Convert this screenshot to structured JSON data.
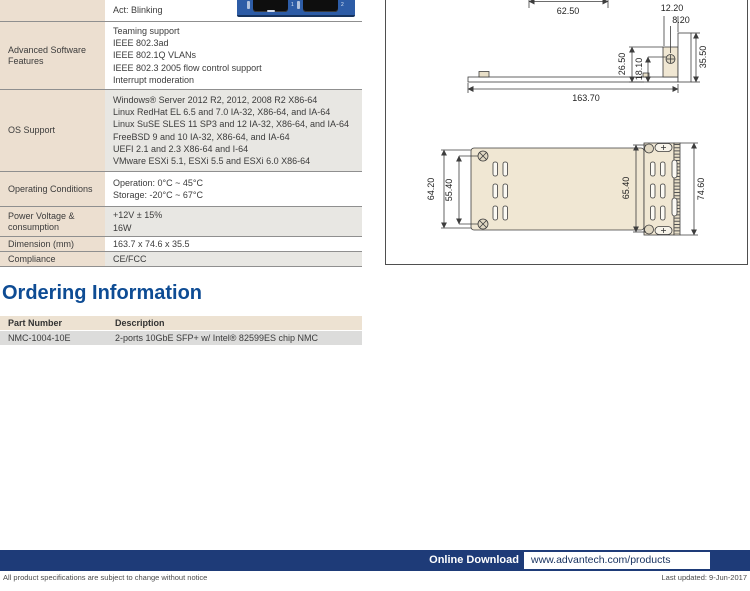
{
  "colors": {
    "heading_blue": "#0e4c94",
    "footer_navy": "#1e3b78",
    "table_label_beige": "#ecdfd0",
    "table_alt_gray": "#e8e7e3",
    "drawing_beige": "#f0e7d3",
    "photo_blue": "#2d5ca6"
  },
  "spec_table": {
    "rows": [
      {
        "label": "",
        "values": [
          "Act: Blinking"
        ]
      },
      {
        "label": "Advanced Software Features",
        "values": [
          "Teaming support",
          "IEEE 802.3ad",
          "IEEE 802.1Q VLANs",
          "IEEE 802.3 2005 flow control support",
          "Interrupt moderation"
        ]
      },
      {
        "label": "OS Support",
        "values": [
          "Windows® Server 2012 R2, 2012, 2008 R2 X86-64",
          "Linux RedHat EL 6.5 and 7.0 IA-32, X86-64, and IA-64",
          "Linux SuSE SLES 11 SP3 and 12 IA-32, X86-64, and IA-64",
          "FreeBSD 9 and 10 IA-32, X86-64, and IA-64",
          "UEFI 2.1 and 2.3 X86-64 and I-64",
          "VMware ESXi 5.1, ESXi 5.5 and ESXi 6.0 X86-64"
        ]
      },
      {
        "label": "Operating Conditions",
        "values": [
          "Operation: 0°C ~ 45°C",
          "Storage: -20°C ~ 67°C"
        ]
      },
      {
        "label": "Power Voltage & consumption",
        "values": [
          "+12V ± 15%",
          "16W"
        ]
      },
      {
        "label": "Dimension (mm)",
        "values": [
          "163.7 x 74.6 x 35.5"
        ]
      },
      {
        "label": "Compliance",
        "values": [
          "CE/FCC"
        ]
      }
    ]
  },
  "photo": {
    "port1": "1",
    "port2": "2"
  },
  "drawings": {
    "dims": {
      "d62_50": "62.50",
      "d12_20": "12.20",
      "d8_20": "8.20",
      "d26_50": "26.50",
      "d18_10": "18.10",
      "d35_50": "35.50",
      "d163_70": "163.70",
      "d64_20": "64.20",
      "d55_40": "55.40",
      "d65_40": "65.40",
      "d74_60": "74.60"
    }
  },
  "ordering": {
    "heading": "Ordering Information",
    "columns": [
      "Part Number",
      "Description"
    ],
    "rows": [
      {
        "part_number": "NMC-1004-10E",
        "description": "2-ports 10GbE SFP+ w/ Intel® 82599ES chip NMC"
      }
    ]
  },
  "footer": {
    "online_download_label": "Online Download",
    "url": "www.advantech.com/products",
    "disclaimer": "All product specifications are subject to change without notice",
    "last_updated": "Last updated: 9-Jun-2017"
  }
}
